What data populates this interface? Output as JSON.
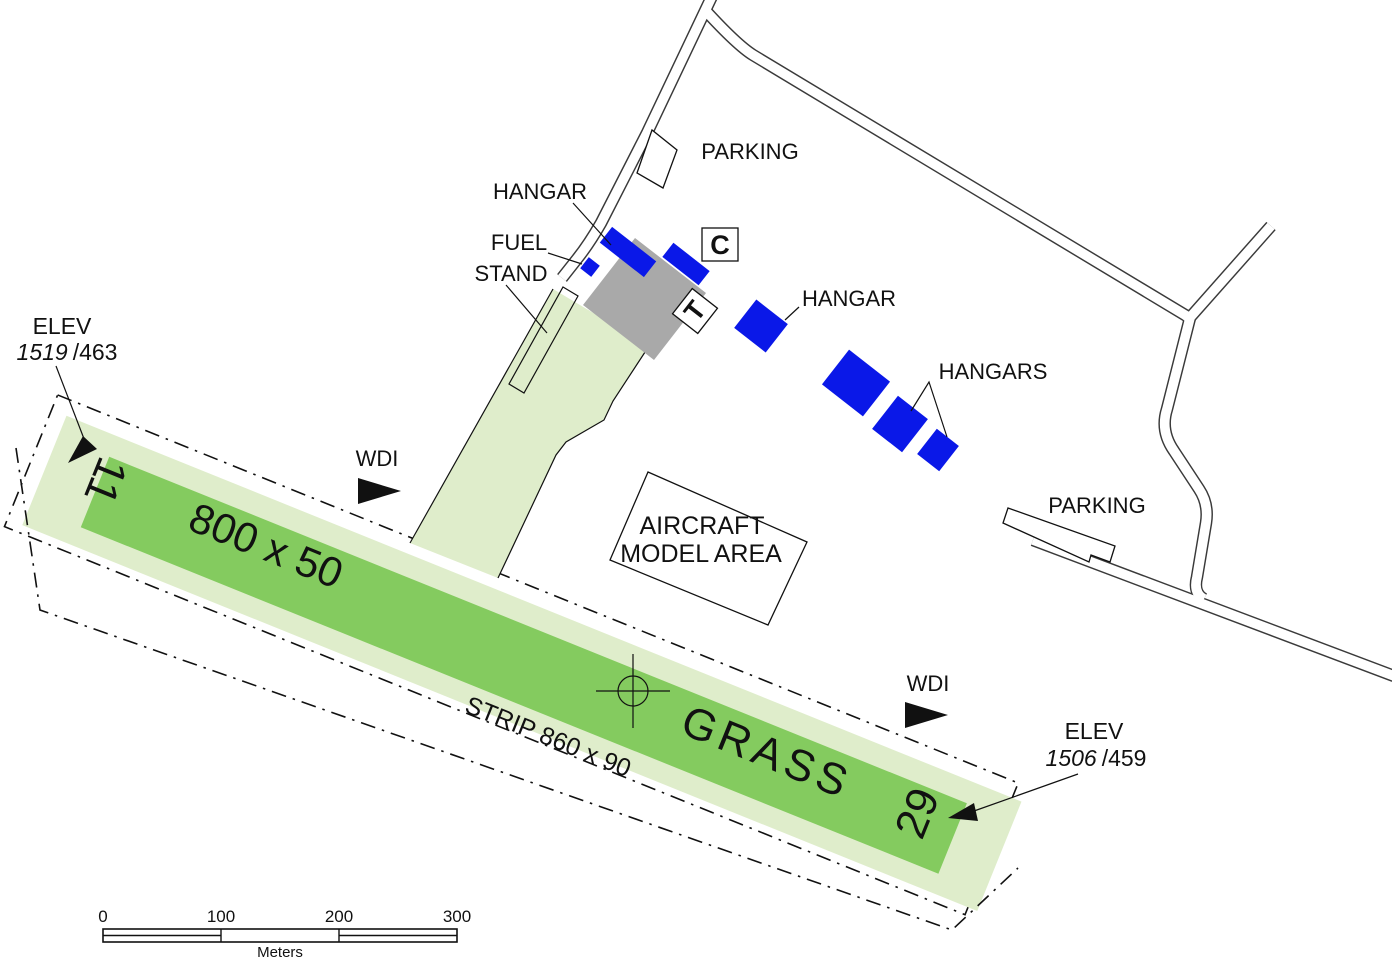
{
  "diagram": {
    "colors": {
      "runway_green": "#84CB5F",
      "strip_green": "#DFEDCB",
      "hangar_blue": "#0A18E8",
      "apron_gray": "#A9A9A9"
    },
    "runway": {
      "designator_west": "11",
      "designator_east": "29",
      "dimensions": "800 x 50",
      "surface": "GRASS",
      "strip_label": "STRIP 860 x 90"
    },
    "elevations": {
      "rwy11": {
        "title": "ELEV",
        "value_italic": "1519",
        "value_regular": "/463"
      },
      "rwy29": {
        "title": "ELEV",
        "value_italic": "1506",
        "value_regular": "/459"
      }
    },
    "wdi_label": "WDI",
    "buildings": {
      "hangar_west_label": "HANGAR",
      "hangar_east_label": "HANGAR",
      "hangars_group_label": "HANGARS",
      "fuel_label": "FUEL",
      "stand_label": "STAND"
    },
    "areas": {
      "parking_north_label": "PARKING",
      "parking_east_label": "PARKING",
      "aircraft_model_line1": "AIRCRAFT",
      "aircraft_model_line2": "MODEL AREA"
    },
    "signs": {
      "c_sign": "C",
      "t_sign": "T"
    },
    "scale_bar": {
      "ticks": [
        "0",
        "100",
        "200",
        "300"
      ],
      "unit": "Meters"
    }
  }
}
